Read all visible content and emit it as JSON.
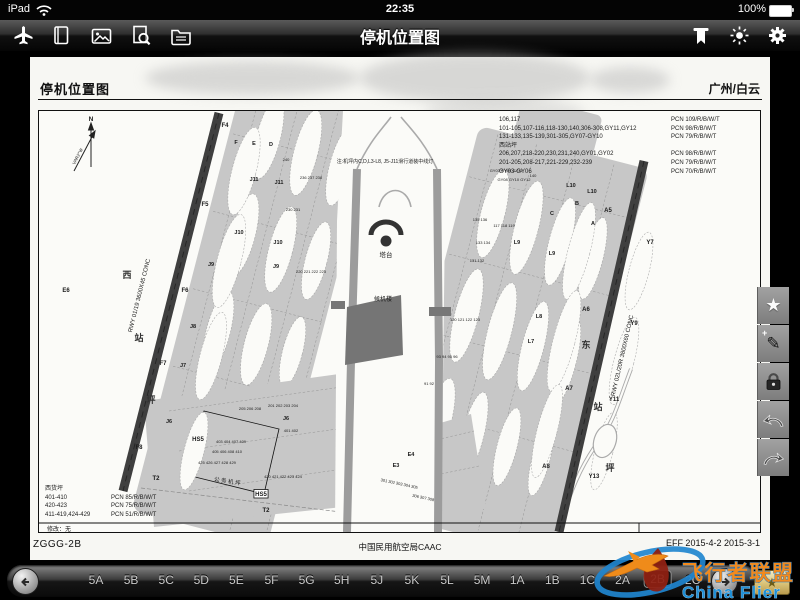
{
  "status_bar": {
    "device": "iPad",
    "time": "22:35",
    "battery": "100%"
  },
  "nav_bar": {
    "title": "停机位置图",
    "left_icons": [
      "airplane",
      "book",
      "photos",
      "search-document",
      "folder"
    ],
    "right_icons": [
      "moon",
      "ribbon",
      "brightness",
      "settings"
    ]
  },
  "side_toolbar": {
    "buttons": [
      "favorite",
      "annotate",
      "lock",
      "undo",
      "redo"
    ]
  },
  "bottom_bar": {
    "tabs": [
      "5A",
      "5B",
      "5C",
      "5D",
      "5E",
      "5F",
      "5G",
      "5H",
      "5J",
      "5K",
      "5L",
      "5M",
      "1A",
      "1B",
      "1C",
      "2A",
      "2B",
      "2C"
    ],
    "selected": "2B"
  },
  "watermark": {
    "line1": "飞行者联盟",
    "line2": "China Flier"
  },
  "page": {
    "header_title": "停机位置图",
    "header_airport": "广州/白云",
    "footer_left": "ZGGG-2B",
    "footer_center": "中国民用航空局CAAC",
    "footer_right": "EFF 2015-4-2  2015-3-1",
    "chart": {
      "pcn_top": [
        [
          "106,117",
          "PCN 109/R/B/W/T"
        ],
        [
          "101-105,107-116,118-130,140,306-308,GY11,GY12",
          "PCN 98/R/B/W/T"
        ],
        [
          "131-133,135-139,301-305,GY07-GY10",
          "PCN 79/R/B/W/T"
        ],
        [
          "西站坪",
          ""
        ],
        [
          "206,207,218-220,230,231,240,GY01,GY02",
          "PCN 98/R/B/W/T"
        ],
        [
          "201-205,208-217,221-229,232-239",
          "PCN 79/R/B/W/T"
        ],
        [
          "GY03-GY06",
          "PCN 70/R/B/W/T"
        ]
      ],
      "pcn_bottom_heading": "西货坪",
      "pcn_bottom": [
        [
          "401-410",
          "PCN 85/R/B/W/T"
        ],
        [
          "420-423",
          "PCN 75/R/B/W/T"
        ],
        [
          "411-419,424-429",
          "PCN 51/R/B/W/T"
        ]
      ],
      "labels": [
        {
          "t": "N",
          "x": 52,
          "y": 10,
          "s": 6.5,
          "b": 1
        },
        {
          "t": "VAR2°W",
          "x": 40,
          "y": 46,
          "s": 4.5,
          "r": -62
        },
        {
          "t": "注:机坪内C,D,L3-L8, J5-J11滑行道装中线灯",
          "x": 346,
          "y": 52,
          "s": 5
        },
        {
          "t": "RWY 01/19 3600X45 CONC",
          "x": 102,
          "y": 185,
          "s": 6,
          "r": -76
        },
        {
          "t": "RWY 02L/20R 3800X60 CONC",
          "x": 585,
          "y": 245,
          "s": 6,
          "r": -77
        },
        {
          "t": "塔台",
          "x": 347,
          "y": 146,
          "s": 6.5
        },
        {
          "t": "候机楼",
          "x": 344,
          "y": 190,
          "s": 6
        },
        {
          "t": "西",
          "x": 88,
          "y": 167,
          "s": 9,
          "b": 1,
          "c": "#333"
        },
        {
          "t": "站",
          "x": 100,
          "y": 230,
          "s": 9,
          "b": 1,
          "c": "#333"
        },
        {
          "t": "坪",
          "x": 112,
          "y": 292,
          "s": 9,
          "b": 1,
          "c": "#333"
        },
        {
          "t": "东",
          "x": 547,
          "y": 237,
          "s": 9,
          "b": 1,
          "c": "#333"
        },
        {
          "t": "站",
          "x": 559,
          "y": 299,
          "s": 9,
          "b": 1,
          "c": "#333"
        },
        {
          "t": "坪",
          "x": 571,
          "y": 360,
          "s": 9,
          "b": 1,
          "c": "#333"
        },
        {
          "t": "公 务 机 坪",
          "x": 188,
          "y": 372,
          "s": 5.5,
          "r": 9
        },
        {
          "t": "修改：无",
          "x": 8,
          "y": 420,
          "s": 6,
          "a": "start"
        },
        {
          "t": "F4",
          "x": 186,
          "y": 16,
          "s": 6,
          "b": 1
        },
        {
          "t": "F5",
          "x": 166,
          "y": 95,
          "s": 6,
          "b": 1
        },
        {
          "t": "F6",
          "x": 146,
          "y": 181,
          "s": 6,
          "b": 1
        },
        {
          "t": "F7",
          "x": 124,
          "y": 254,
          "s": 6,
          "b": 1
        },
        {
          "t": "F8",
          "x": 100,
          "y": 338,
          "s": 6,
          "b": 1
        },
        {
          "t": "E6",
          "x": 27,
          "y": 181,
          "s": 6,
          "b": 1
        },
        {
          "t": "J11",
          "x": 215,
          "y": 70,
          "s": 5.5,
          "b": 1
        },
        {
          "t": "J11",
          "x": 240,
          "y": 73,
          "s": 5.5,
          "b": 1
        },
        {
          "t": "J10",
          "x": 200,
          "y": 123,
          "s": 5.5,
          "b": 1
        },
        {
          "t": "J10",
          "x": 239,
          "y": 133,
          "s": 5.5,
          "b": 1
        },
        {
          "t": "J9",
          "x": 172,
          "y": 155,
          "s": 5.5,
          "b": 1
        },
        {
          "t": "J9",
          "x": 237,
          "y": 157,
          "s": 5.5,
          "b": 1
        },
        {
          "t": "J8",
          "x": 154,
          "y": 217,
          "s": 5.5,
          "b": 1
        },
        {
          "t": "J7",
          "x": 144,
          "y": 256,
          "s": 5.5,
          "b": 1
        },
        {
          "t": "J6",
          "x": 130,
          "y": 312,
          "s": 5.5,
          "b": 1
        },
        {
          "t": "J6",
          "x": 247,
          "y": 309,
          "s": 5.5,
          "b": 1
        },
        {
          "t": "T2",
          "x": 117,
          "y": 369,
          "s": 6,
          "b": 1
        },
        {
          "t": "T2",
          "x": 227,
          "y": 401,
          "s": 6,
          "b": 1
        },
        {
          "t": "HS5",
          "x": 159,
          "y": 330,
          "s": 6,
          "b": 1
        },
        {
          "t": "HS5",
          "x": 222,
          "y": 385,
          "s": 6,
          "b": 1,
          "box": 1
        },
        {
          "t": "L10",
          "x": 532,
          "y": 76,
          "s": 5.5,
          "b": 1
        },
        {
          "t": "L10",
          "x": 553,
          "y": 82,
          "s": 5.5,
          "b": 1
        },
        {
          "t": "L9",
          "x": 478,
          "y": 133,
          "s": 5.5,
          "b": 1
        },
        {
          "t": "L9",
          "x": 513,
          "y": 144,
          "s": 5.5,
          "b": 1
        },
        {
          "t": "L8",
          "x": 500,
          "y": 207,
          "s": 5.5,
          "b": 1
        },
        {
          "t": "L7",
          "x": 492,
          "y": 232,
          "s": 5.5,
          "b": 1
        },
        {
          "t": "A5",
          "x": 569,
          "y": 101,
          "s": 6,
          "b": 1
        },
        {
          "t": "A6",
          "x": 547,
          "y": 200,
          "s": 6,
          "b": 1
        },
        {
          "t": "A7",
          "x": 530,
          "y": 279,
          "s": 6,
          "b": 1
        },
        {
          "t": "A8",
          "x": 507,
          "y": 357,
          "s": 6,
          "b": 1
        },
        {
          "t": "Y7",
          "x": 611,
          "y": 133,
          "s": 6,
          "b": 1
        },
        {
          "t": "Y9",
          "x": 595,
          "y": 214,
          "s": 6,
          "b": 1
        },
        {
          "t": "Y11",
          "x": 575,
          "y": 290,
          "s": 6,
          "b": 1
        },
        {
          "t": "Y13",
          "x": 555,
          "y": 367,
          "s": 6,
          "b": 1
        },
        {
          "t": "B",
          "x": 538,
          "y": 94,
          "s": 5.5,
          "b": 1
        },
        {
          "t": "C",
          "x": 513,
          "y": 104,
          "s": 5.5,
          "b": 1
        },
        {
          "t": "A",
          "x": 554,
          "y": 114,
          "s": 5.5,
          "b": 1
        },
        {
          "t": "F",
          "x": 197,
          "y": 33,
          "s": 5.5,
          "b": 1
        },
        {
          "t": "E",
          "x": 215,
          "y": 34,
          "s": 5.5,
          "b": 1
        },
        {
          "t": "D",
          "x": 232,
          "y": 35,
          "s": 5.5,
          "b": 1
        },
        {
          "t": "E3",
          "x": 357,
          "y": 356,
          "s": 5.5,
          "b": 1
        },
        {
          "t": "E4",
          "x": 372,
          "y": 345,
          "s": 5.5,
          "b": 1
        },
        {
          "t": "240",
          "x": 247,
          "y": 50,
          "s": 4
        },
        {
          "t": "236 237 238",
          "x": 272,
          "y": 68,
          "s": 4
        },
        {
          "t": "230 231",
          "x": 254,
          "y": 100,
          "s": 4
        },
        {
          "t": "220 221 222 223",
          "x": 272,
          "y": 162,
          "s": 4
        },
        {
          "t": "205 206 208",
          "x": 211,
          "y": 299,
          "s": 4
        },
        {
          "t": "201 202 203 204",
          "x": 244,
          "y": 296,
          "s": 4
        },
        {
          "t": "140",
          "x": 494,
          "y": 66,
          "s": 4
        },
        {
          "t": "GY07 GY09 GY11",
          "x": 467,
          "y": 61,
          "s": 4
        },
        {
          "t": "GY08 GY10 GY12",
          "x": 475,
          "y": 70,
          "s": 4
        },
        {
          "t": "135 136",
          "x": 441,
          "y": 110,
          "s": 4
        },
        {
          "t": "133 134",
          "x": 444,
          "y": 133,
          "s": 4
        },
        {
          "t": "131 132",
          "x": 438,
          "y": 151,
          "s": 4
        },
        {
          "t": "117 118 119",
          "x": 465,
          "y": 116,
          "s": 4
        },
        {
          "t": "120 121 122 123",
          "x": 426,
          "y": 210,
          "s": 4
        },
        {
          "t": "93 94 95 96",
          "x": 408,
          "y": 247,
          "s": 4
        },
        {
          "t": "91 92",
          "x": 390,
          "y": 274,
          "s": 4
        },
        {
          "t": "401 402",
          "x": 252,
          "y": 321,
          "s": 4
        },
        {
          "t": "403 404 407 409",
          "x": 192,
          "y": 332,
          "s": 4
        },
        {
          "t": "405 406 408 410",
          "x": 188,
          "y": 342,
          "s": 4
        },
        {
          "t": "420 421 422 423 424",
          "x": 244,
          "y": 367,
          "s": 4
        },
        {
          "t": "425 426 427 428 429",
          "x": 178,
          "y": 353,
          "s": 4
        },
        {
          "t": "301 302 303 304 305",
          "x": 360,
          "y": 374,
          "s": 4,
          "r": 12
        },
        {
          "t": "306 307 308",
          "x": 384,
          "y": 388,
          "s": 4,
          "r": 12
        }
      ]
    }
  }
}
